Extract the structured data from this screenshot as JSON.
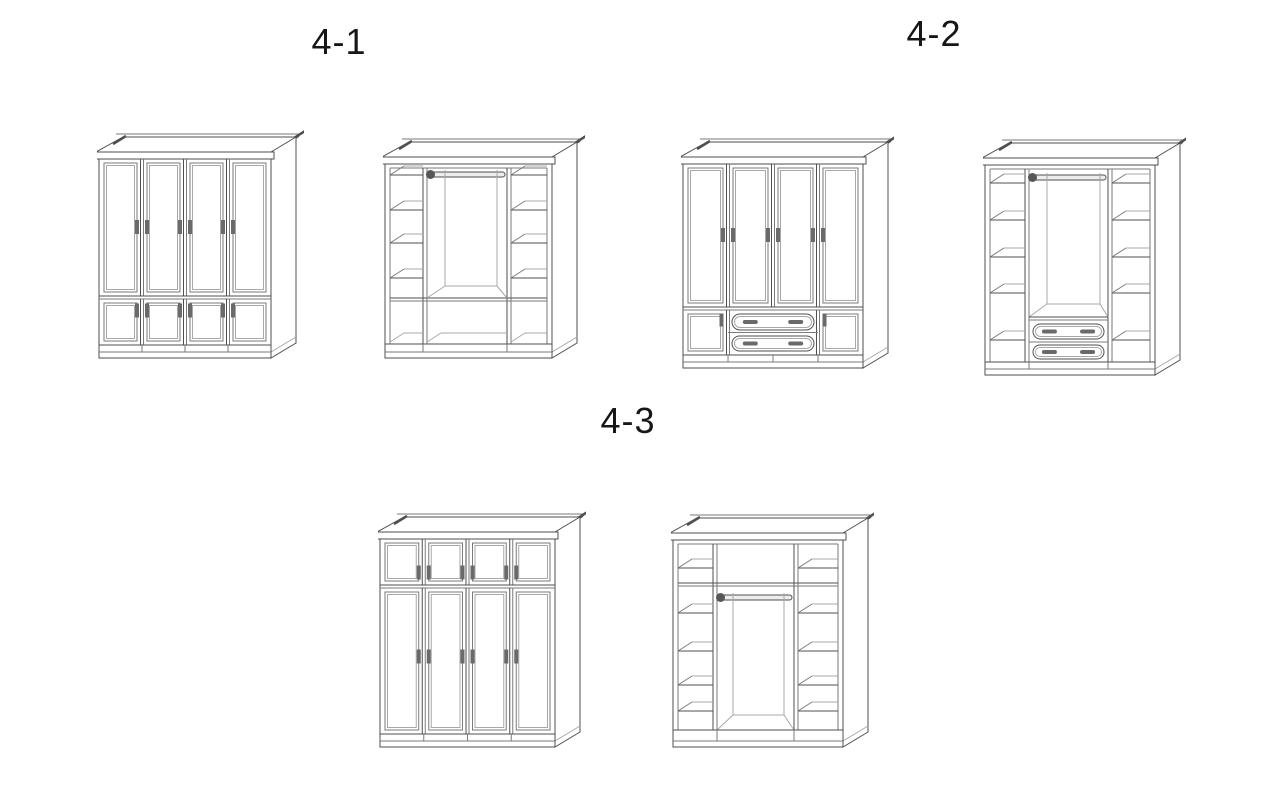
{
  "page": {
    "background": "#ffffff"
  },
  "colors": {
    "line": "#4f4f4f",
    "mid": "#7a7a7a",
    "light": "#a8a8a8",
    "handle": "#6a6a6a",
    "rod_fill": "#ededed",
    "rod_cap": "#575757",
    "fill": "#ffffff",
    "text": "#161616"
  },
  "labels": [
    {
      "id": "4-1",
      "text": "4-1"
    },
    {
      "id": "4-2",
      "text": "4-2"
    },
    {
      "id": "4-3",
      "text": "4-3"
    }
  ],
  "figures": [
    {
      "id": "fig-4-1-closed",
      "group": "4-1",
      "view": "closed",
      "description": "four-door wardrobe with four small lower doors",
      "tall_doors": 4,
      "lower_doors": 4,
      "drawers": 0
    },
    {
      "id": "fig-4-1-open",
      "group": "4-1",
      "view": "open",
      "description": "interior: two shelf columns, hanging rod, three open lower compartments",
      "shelf_columns": 2,
      "shelves_per_column": 4,
      "hanging_rod": true,
      "lower_compartments": 3,
      "drawers": 0
    },
    {
      "id": "fig-4-2-closed",
      "group": "4-2",
      "view": "closed",
      "description": "four-door wardrobe with two small lower doors and two centre drawers",
      "tall_doors": 4,
      "lower_doors": 2,
      "drawers": 2
    },
    {
      "id": "fig-4-2-open",
      "group": "4-2",
      "view": "open",
      "description": "interior: two shelf columns, hanging rod, two centre drawers",
      "shelf_columns": 2,
      "shelves_per_column": 5,
      "hanging_rod": true,
      "drawers": 2
    },
    {
      "id": "fig-4-3-closed",
      "group": "4-3",
      "view": "closed",
      "description": "wardrobe with four small top doors above four tall doors",
      "top_doors": 4,
      "tall_doors": 4,
      "drawers": 0
    },
    {
      "id": "fig-4-3-open",
      "group": "4-3",
      "view": "open",
      "description": "interior: three top compartments, two shelf columns, hanging rod",
      "top_compartments": 3,
      "shelf_columns": 2,
      "shelves_per_column": 4,
      "hanging_rod": true,
      "drawers": 0
    }
  ]
}
